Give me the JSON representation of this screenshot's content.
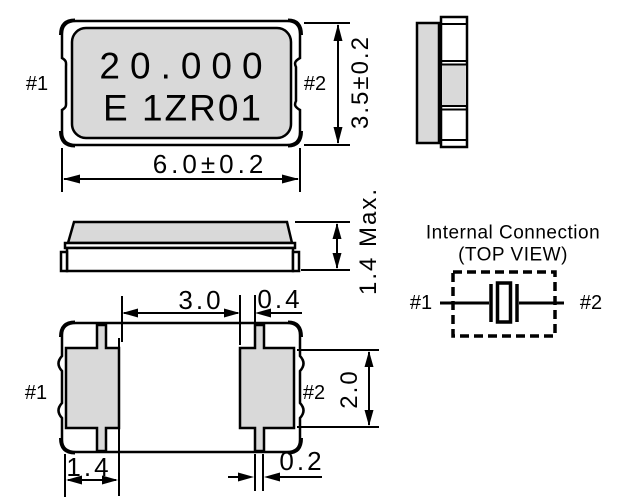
{
  "colors": {
    "fill_gray": "#d9d9d9",
    "line": "#000000",
    "bg": "#ffffff"
  },
  "top_view": {
    "pin1": "#1",
    "pin2": "#2",
    "marking_line1": "20.000",
    "marking_line2": "E 1ZR01",
    "dim_width": "6.0±0.2",
    "dim_height": "3.5±0.2"
  },
  "side_view": {
    "dim_height": "1.4 Max."
  },
  "bottom_view": {
    "pin1": "#1",
    "pin2": "#2",
    "dim_pad_gap": "3.0",
    "dim_tab_offset": "0.4",
    "dim_pad_height": "2.0",
    "dim_pad_width": "1.4",
    "dim_tab_width": "0.2"
  },
  "internal_connection": {
    "title": "Internal Connection",
    "subtitle": "(TOP VIEW)",
    "pin1": "#1",
    "pin2": "#2"
  }
}
